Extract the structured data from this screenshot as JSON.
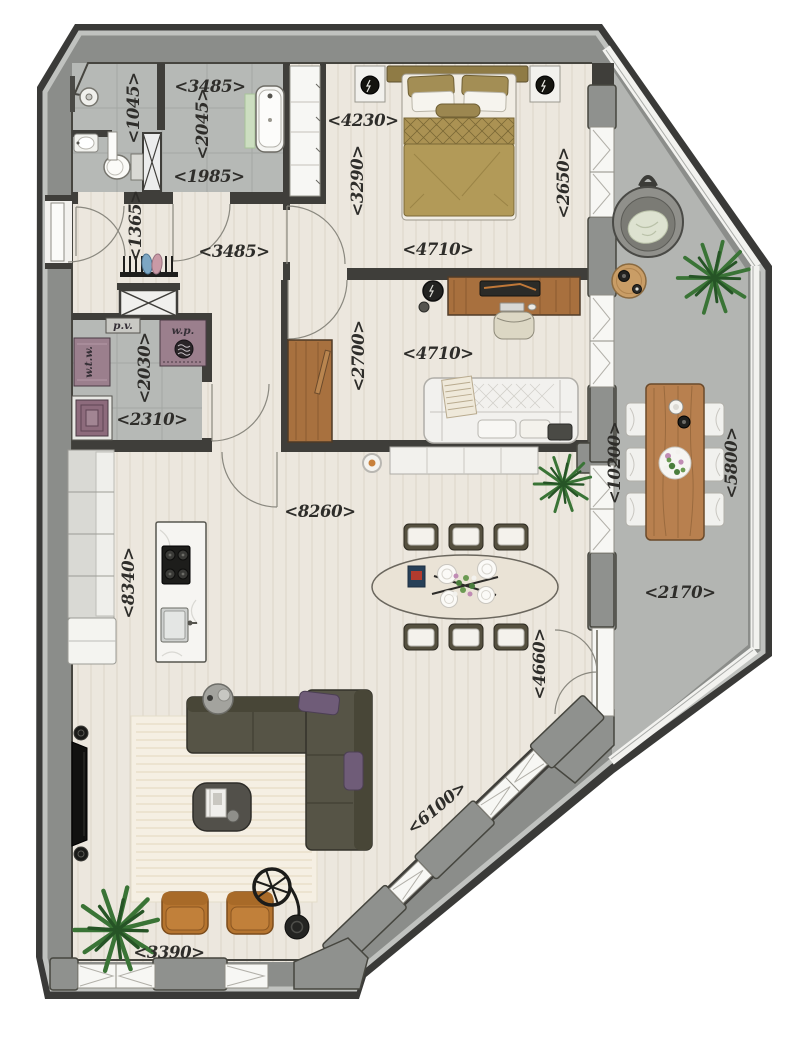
{
  "plan": {
    "dims": {
      "bath_small_w": "<1045>",
      "bath_top_w": "<3485>",
      "bath_h": "<2045>",
      "bath_bottom_w": "<1985>",
      "bedroom_top_w": "<4230>",
      "bedroom_h": "<3290>",
      "bedroom_right_h": "<2650>",
      "bedroom_bottom_w": "<4710>",
      "hall_h": "<1365>",
      "hall_w": "<3485>",
      "utility_h": "<2030>",
      "utility_w": "<2310>",
      "office_h": "<2700>",
      "office_w": "<4710>",
      "living_w": "<8260>",
      "living_h": "<8340>",
      "terrace_left_h": "<10200>",
      "terrace_right_h": "<5800>",
      "terrace_w": "<2170>",
      "dining_h": "<4660>",
      "facade_diag_w": "<6100>",
      "lounge_w": "<3390>"
    },
    "equipment": {
      "pv": "p.v.",
      "wp": "w.p.",
      "wtw": "w.t.w."
    }
  }
}
